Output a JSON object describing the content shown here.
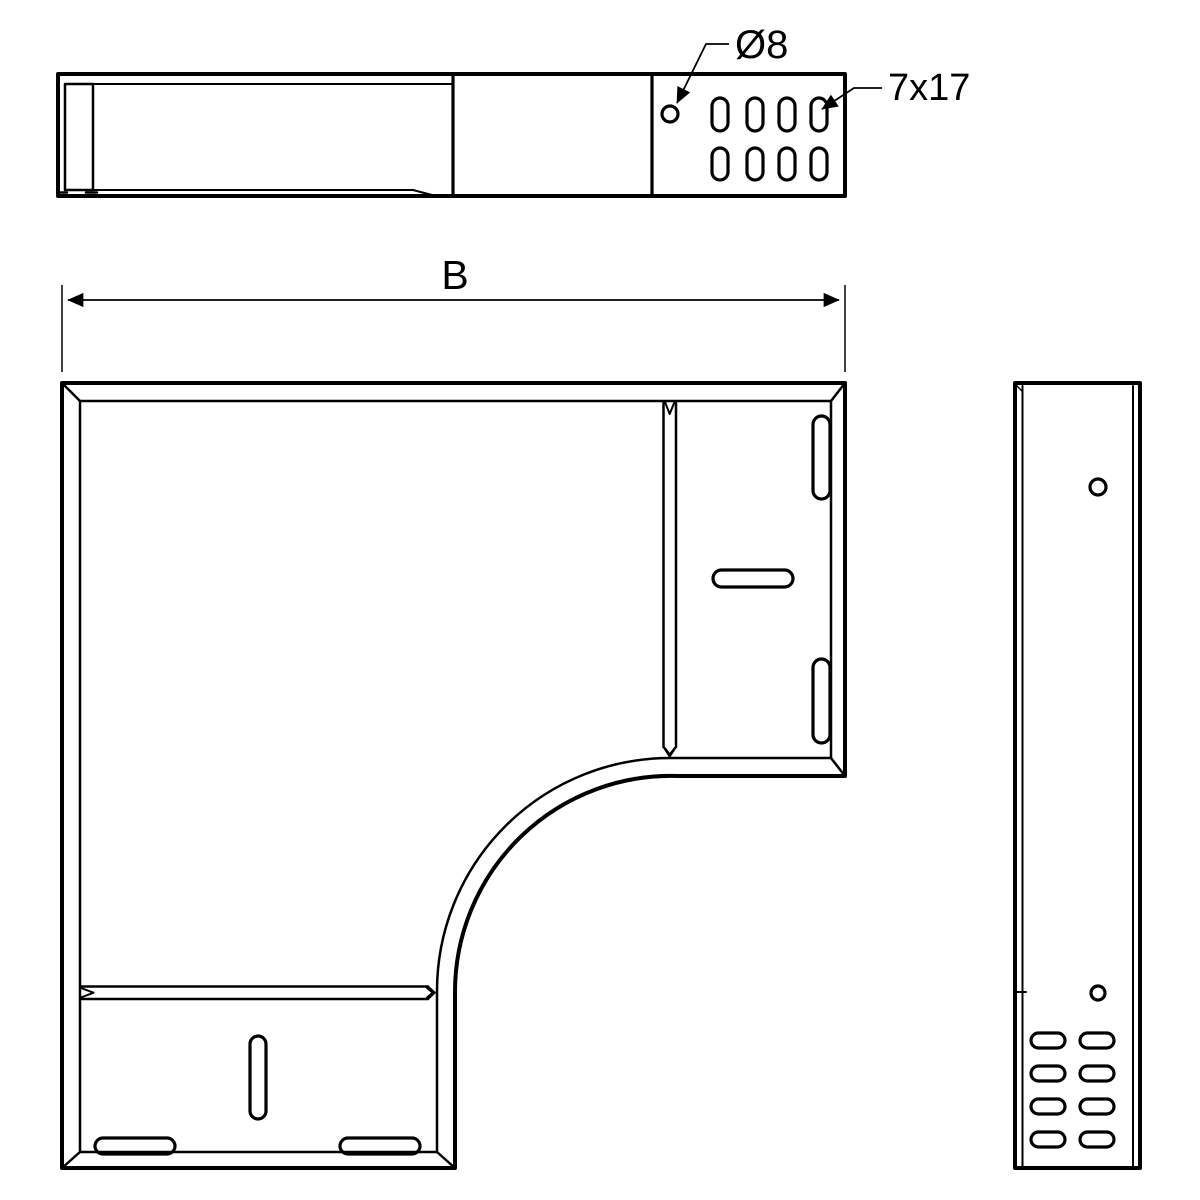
{
  "annotations": {
    "hole_diameter": "Ø8",
    "slot_size": "7x17",
    "width_dim": "B"
  },
  "colors": {
    "line": "#000000",
    "background": "#ffffff"
  }
}
